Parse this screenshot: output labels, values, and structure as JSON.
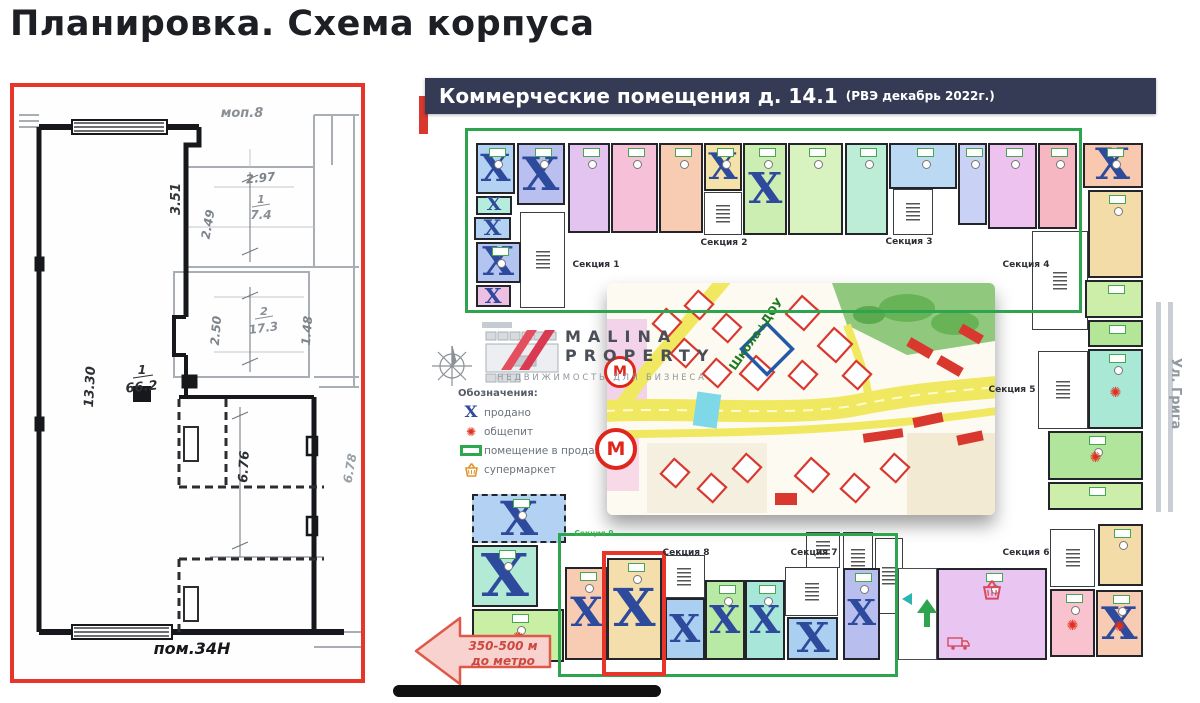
{
  "title": "Планировка. Схема корпуса",
  "left_plan": {
    "unit_label": "пом.34Н",
    "dimensions": [
      {
        "text": "моп.8",
        "x": 228,
        "y": 30,
        "rot": 0,
        "color": "#8a8f96",
        "size": 13,
        "italic": true
      },
      {
        "text": "2.97",
        "x": 247,
        "y": 95,
        "rot": -6,
        "color": "#7d838b",
        "size": 12,
        "italic": true
      },
      {
        "text": "3.51",
        "x": 166,
        "y": 112,
        "rot": -90,
        "color": "#33363b",
        "size": 13,
        "italic": true
      },
      {
        "text": "2.49",
        "x": 198,
        "y": 138,
        "rot": -80,
        "color": "#7d838b",
        "size": 12,
        "italic": true
      },
      {
        "text": "1",
        "x": 247,
        "y": 116,
        "rot": 0,
        "color": "#8a8f96",
        "size": 11,
        "italic": true
      },
      {
        "text": "7.4",
        "x": 247,
        "y": 132,
        "rot": 0,
        "color": "#8a8f96",
        "size": 12,
        "italic": true
      },
      {
        "text": "2.50",
        "x": 206,
        "y": 244,
        "rot": -85,
        "color": "#7d838b",
        "size": 12,
        "italic": true
      },
      {
        "text": "2",
        "x": 250,
        "y": 228,
        "rot": 0,
        "color": "#8a8f96",
        "size": 11,
        "italic": true
      },
      {
        "text": "17.3",
        "x": 250,
        "y": 245,
        "rot": -8,
        "color": "#8a8f96",
        "size": 12,
        "italic": true
      },
      {
        "text": "1.48",
        "x": 297,
        "y": 244,
        "rot": -85,
        "color": "#7d838b",
        "size": 12,
        "italic": true
      },
      {
        "text": "13.30",
        "x": 80,
        "y": 300,
        "rot": -87,
        "color": "#2c2f34",
        "size": 13,
        "italic": true
      },
      {
        "text": "1",
        "x": 128,
        "y": 287,
        "rot": 0,
        "color": "#2c2f34",
        "size": 12,
        "italic": true
      },
      {
        "text": "66.2",
        "x": 128,
        "y": 304,
        "rot": -6,
        "color": "#2c2f34",
        "size": 13,
        "italic": true
      },
      {
        "text": "6.76",
        "x": 234,
        "y": 380,
        "rot": -87,
        "color": "#2c2f34",
        "size": 13,
        "italic": true
      },
      {
        "text": "6.78",
        "x": 340,
        "y": 382,
        "rot": -80,
        "color": "#9aa0a7",
        "size": 12,
        "italic": true
      },
      {
        "text": "пом.34Н",
        "x": 178,
        "y": 567,
        "rot": 0,
        "color": "#17181c",
        "size": 16,
        "italic": true,
        "bold": true
      }
    ]
  },
  "scheme": {
    "header": {
      "title": "Коммерческие помещения д. 14.1",
      "subtitle": "(РВЭ  декабрь 2022г.)"
    },
    "sold_symbol": "X",
    "legend": {
      "title": "Обозначения:",
      "items": [
        {
          "icon": "sold-x",
          "label": "продано"
        },
        {
          "icon": "food",
          "label": "общепит"
        },
        {
          "icon": "for-sale",
          "label": "помещение в продаже"
        },
        {
          "icon": "basket",
          "label": "супермаркет"
        }
      ]
    },
    "logo": {
      "name_line1": "MALINA",
      "name_line2": "PROPERTY",
      "tagline": "НЕДВИЖИМОСТЬ ДЛЯ БИЗНЕСА"
    },
    "map": {
      "school_label": "Школа+ДОУ",
      "metro_letter": "М"
    },
    "street_label": "Ул. Грига",
    "metro_distance": {
      "line1": "350-500 м",
      "line2": "до метро"
    },
    "sections": [
      {
        "label": "Секция 1",
        "x": 596,
        "y": 260
      },
      {
        "label": "Секция 2",
        "x": 724,
        "y": 238
      },
      {
        "label": "Секция 3",
        "x": 909,
        "y": 237
      },
      {
        "label": "Секция 4",
        "x": 1026,
        "y": 260
      },
      {
        "label": "Секция 5",
        "x": 1012,
        "y": 385
      },
      {
        "label": "Секция 9",
        "x": 594,
        "y": 529,
        "green": true
      },
      {
        "label": "Секция 8",
        "x": 686,
        "y": 548
      },
      {
        "label": "Секция 7",
        "x": 814,
        "y": 548
      },
      {
        "label": "Секция 6",
        "x": 1026,
        "y": 548
      }
    ],
    "units": [
      {
        "x": 476,
        "y": 143,
        "w": 39,
        "h": 51,
        "c": "#b3d1f2",
        "sold": true,
        "tag": true
      },
      {
        "x": 517,
        "y": 143,
        "w": 48,
        "h": 62,
        "c": "#b9bfee",
        "sold": true,
        "tag": true
      },
      {
        "x": 476,
        "y": 196,
        "w": 36,
        "h": 19,
        "c": "#b5ecdc",
        "sold": true
      },
      {
        "x": 474,
        "y": 217,
        "w": 37,
        "h": 23,
        "c": "#b3d1f2",
        "sold": true
      },
      {
        "x": 476,
        "y": 242,
        "w": 45,
        "h": 41,
        "c": "#b3c4f0",
        "sold": true,
        "tag": true
      },
      {
        "x": 476,
        "y": 285,
        "w": 35,
        "h": 22,
        "c": "#edbfe3",
        "sold": true
      },
      {
        "x": 568,
        "y": 143,
        "w": 42,
        "h": 90,
        "c": "#e3c4f1",
        "tag": true,
        "mark": true
      },
      {
        "x": 611,
        "y": 143,
        "w": 47,
        "h": 90,
        "c": "#f6c0d8",
        "tag": true,
        "mark": true
      },
      {
        "x": 659,
        "y": 143,
        "w": 44,
        "h": 90,
        "c": "#f8ccb2",
        "tag": true,
        "mark": true
      },
      {
        "x": 704,
        "y": 143,
        "w": 38,
        "h": 48,
        "c": "#f4e2a8",
        "sold": true,
        "tag": true
      },
      {
        "x": 743,
        "y": 143,
        "w": 44,
        "h": 92,
        "c": "#cdeeb2",
        "sold": true,
        "tag": true
      },
      {
        "x": 788,
        "y": 143,
        "w": 55,
        "h": 92,
        "c": "#d8f2c0",
        "tag": true,
        "mark": true
      },
      {
        "x": 845,
        "y": 143,
        "w": 43,
        "h": 92,
        "c": "#bdedd6",
        "tag": true,
        "mark": true
      },
      {
        "x": 889,
        "y": 143,
        "w": 68,
        "h": 46,
        "c": "#bcd9f4",
        "tag": true,
        "mark": true
      },
      {
        "x": 958,
        "y": 143,
        "w": 29,
        "h": 82,
        "c": "#c9d2f4",
        "tag": true
      },
      {
        "x": 988,
        "y": 143,
        "w": 49,
        "h": 86,
        "c": "#edc2ee",
        "tag": true,
        "mark": true
      },
      {
        "x": 1038,
        "y": 143,
        "w": 39,
        "h": 86,
        "c": "#f6b6c2",
        "tag": true
      },
      {
        "x": 1083,
        "y": 143,
        "w": 60,
        "h": 45,
        "c": "#f8c9ae",
        "sold": true,
        "tag": true
      },
      {
        "x": 1088,
        "y": 190,
        "w": 55,
        "h": 88,
        "c": "#f3dca8",
        "tag": true,
        "mark": true
      },
      {
        "x": 1085,
        "y": 280,
        "w": 58,
        "h": 38,
        "c": "#cdeea8",
        "tag": true
      },
      {
        "x": 1088,
        "y": 320,
        "w": 55,
        "h": 27,
        "c": "#b4e698",
        "tag": true
      },
      {
        "x": 1088,
        "y": 349,
        "w": 55,
        "h": 80,
        "c": "#a8e8d4",
        "icon": "food",
        "tag": true
      },
      {
        "x": 1048,
        "y": 431,
        "w": 95,
        "h": 49,
        "c": "#b2e59c",
        "icon": "food",
        "tag": true
      },
      {
        "x": 1048,
        "y": 482,
        "w": 95,
        "h": 28,
        "c": "#cdeea8",
        "tag": true
      },
      {
        "x": 1098,
        "y": 524,
        "w": 45,
        "h": 62,
        "c": "#f3dca8",
        "tag": true
      },
      {
        "x": 1050,
        "y": 589,
        "w": 45,
        "h": 68,
        "c": "#f8c2ce",
        "icon": "food",
        "tag": true
      },
      {
        "x": 1096,
        "y": 590,
        "w": 47,
        "h": 67,
        "c": "#f8ccb2",
        "sold": true,
        "icon": "food",
        "tag": true
      },
      {
        "x": 472,
        "y": 494,
        "w": 94,
        "h": 49,
        "c": "#b3d1f2",
        "sold": true,
        "dash": true,
        "tag": true
      },
      {
        "x": 472,
        "y": 545,
        "w": 66,
        "h": 62,
        "c": "#b2ead6",
        "sold": true,
        "tag": true
      },
      {
        "x": 472,
        "y": 609,
        "w": 92,
        "h": 53,
        "c": "#c9efa4",
        "icon": "food",
        "tag": true
      },
      {
        "x": 565,
        "y": 567,
        "w": 42,
        "h": 93,
        "c": "#f8ccb2",
        "sold": true,
        "tag": true
      },
      {
        "x": 607,
        "y": 558,
        "w": 55,
        "h": 102,
        "c": "#f4deac",
        "sold": true,
        "tag": true
      },
      {
        "x": 667,
        "y": 599,
        "w": 37,
        "h": 15,
        "c": "#cfe97a"
      },
      {
        "x": 665,
        "y": 598,
        "w": 40,
        "h": 62,
        "c": "#aacff0",
        "sold": true
      },
      {
        "x": 705,
        "y": 580,
        "w": 40,
        "h": 80,
        "c": "#b8eaa6",
        "sold": true,
        "tag": true
      },
      {
        "x": 745,
        "y": 580,
        "w": 40,
        "h": 80,
        "c": "#a8e6da",
        "sold": true,
        "tag": true
      },
      {
        "x": 787,
        "y": 617,
        "w": 51,
        "h": 43,
        "c": "#aacff0",
        "sold": true
      },
      {
        "x": 843,
        "y": 568,
        "w": 37,
        "h": 92,
        "c": "#b8bfee",
        "sold": true,
        "tag": true
      },
      {
        "x": 937,
        "y": 568,
        "w": 110,
        "h": 92,
        "c": "#e9c6f2",
        "icon": "market",
        "tag": true
      }
    ],
    "cores": [
      {
        "x": 520,
        "y": 212,
        "w": 45,
        "h": 96
      },
      {
        "x": 704,
        "y": 192,
        "w": 38,
        "h": 43
      },
      {
        "x": 893,
        "y": 189,
        "w": 40,
        "h": 46
      },
      {
        "x": 1032,
        "y": 231,
        "w": 56,
        "h": 99
      },
      {
        "x": 1038,
        "y": 351,
        "w": 50,
        "h": 78
      },
      {
        "x": 663,
        "y": 555,
        "w": 42,
        "h": 43
      },
      {
        "x": 785,
        "y": 567,
        "w": 53,
        "h": 49
      },
      {
        "x": 1050,
        "y": 529,
        "w": 45,
        "h": 58
      },
      {
        "x": 875,
        "y": 538,
        "w": 28,
        "h": 76
      },
      {
        "x": 843,
        "y": 532,
        "w": 30,
        "h": 52
      },
      {
        "x": 806,
        "y": 532,
        "w": 34,
        "h": 36
      }
    ]
  }
}
